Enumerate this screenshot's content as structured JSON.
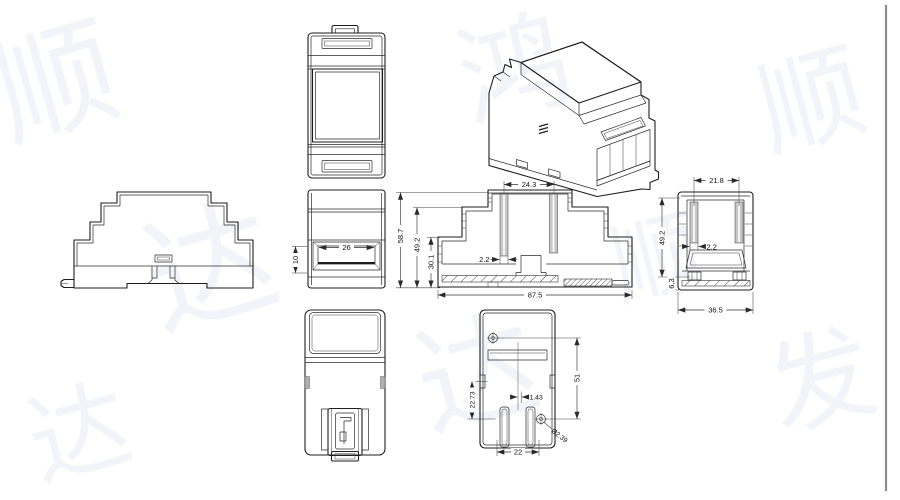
{
  "page": {
    "background": "#ffffff",
    "line_color": "#1e1e1e",
    "rib_fill": "#c7c7c7",
    "divider_color": "#8c8c8c",
    "watermark_color": "#f2f4fa"
  },
  "watermark": {
    "tiles": [
      "顺",
      "达",
      "鸿",
      "达",
      "顺",
      "发",
      "达",
      "顺"
    ]
  },
  "dims": {
    "side_view": {
      "recess_width": "26",
      "recess_height": "10"
    },
    "front_section": {
      "pin_span": "24.3",
      "rib_thickness": "2.2",
      "total_height": "58.7",
      "body_height": "49.2",
      "inner_height": "30.1",
      "total_width": "87.5"
    },
    "side_section": {
      "pin_span": "21.8",
      "rib_thickness": "2.2",
      "body_height": "49.2",
      "foot_height": "6.3",
      "total_width": "36.5"
    },
    "bottom_view": {
      "edge_to_hole": "22.73",
      "center_offset": "1.43",
      "hole_pitch": "51",
      "slot_span": "22",
      "hole_diameter": "Ø2.39"
    }
  }
}
